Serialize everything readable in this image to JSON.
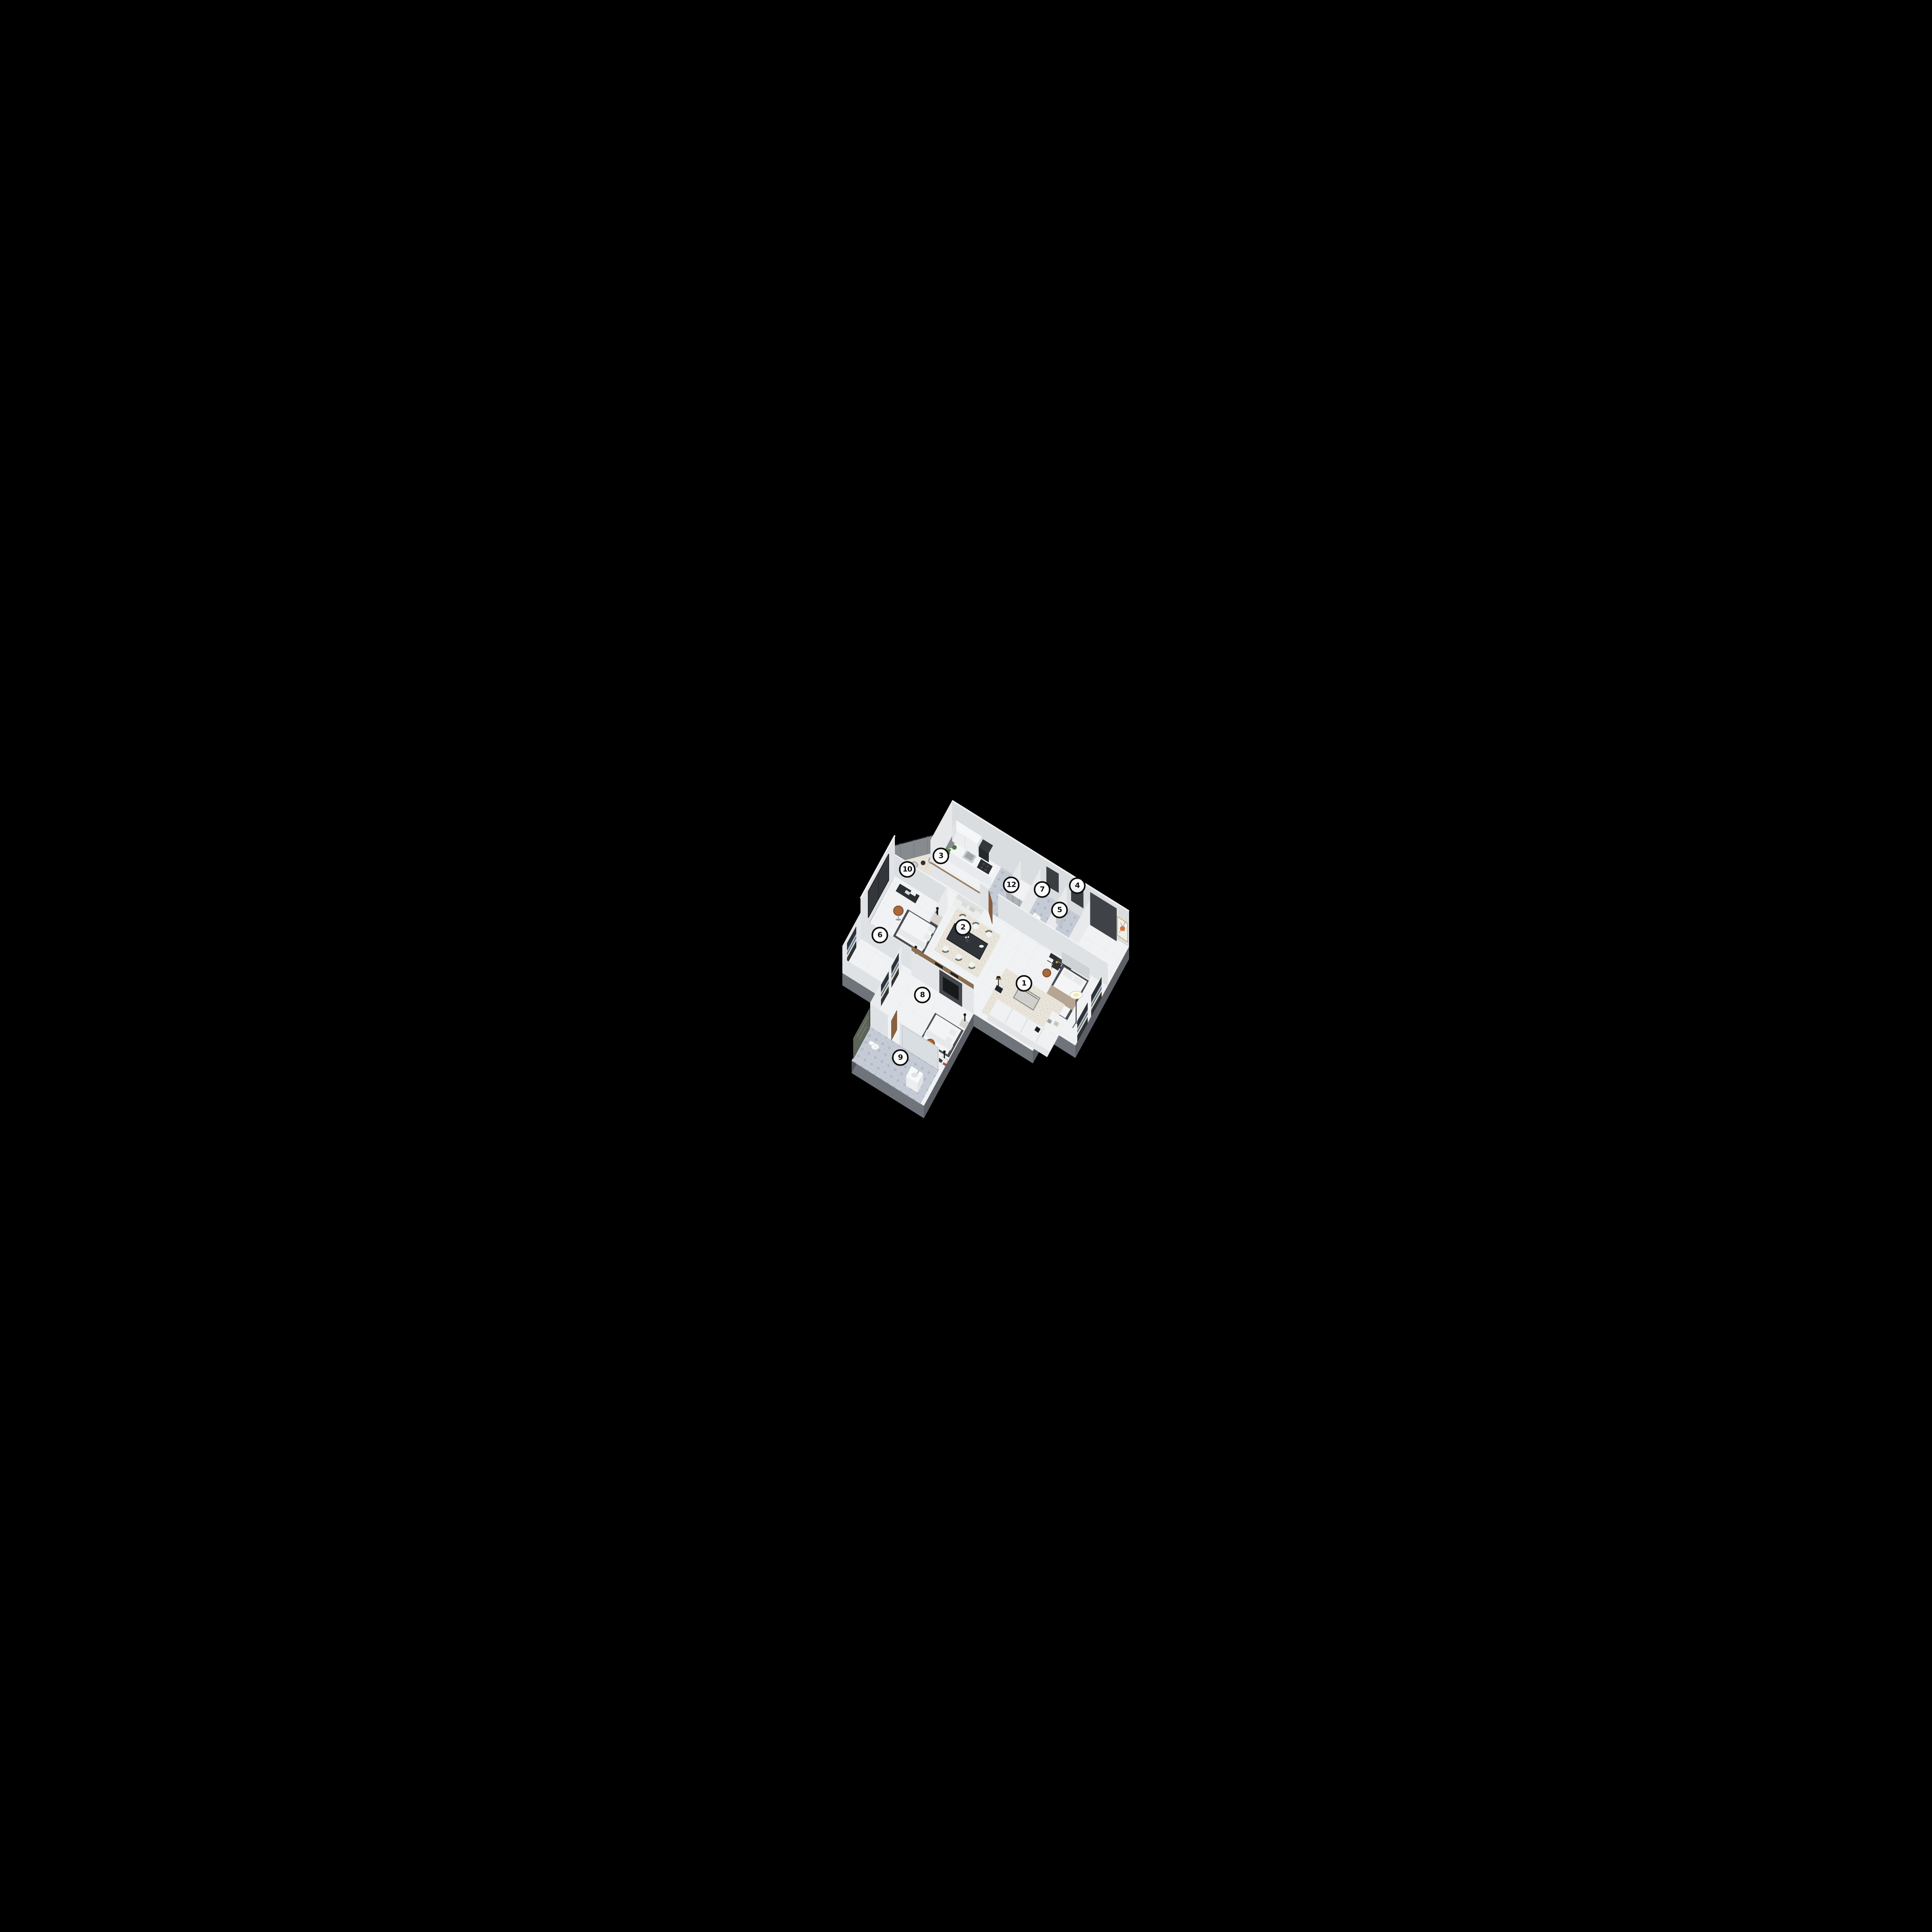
{
  "scene": {
    "type": "isometric-3d-floor-plan",
    "background": "#000000",
    "room_count_labels": 11
  },
  "labels": [
    {
      "value": "1"
    },
    {
      "value": "2"
    },
    {
      "value": "3"
    },
    {
      "value": "4"
    },
    {
      "value": "5"
    },
    {
      "value": "6"
    },
    {
      "value": "7"
    },
    {
      "value": "8"
    },
    {
      "value": "9"
    },
    {
      "value": "10"
    },
    {
      "value": "12"
    }
  ],
  "palette": {
    "background": "#000000",
    "floor_marble": "#f1f2f4",
    "wall": "#dcdfe2",
    "wall_light": "#e8eaec",
    "slab_side": "#5c6066",
    "bath_tile": "#c7cdd7",
    "rug": "#e9e4da",
    "wood": "#8a6f52",
    "door_wood": "#8a5f3c",
    "leather_chair": "#a9693c",
    "olive_chair": "#6e7560",
    "dark_fixture": "#2b2e32",
    "window_dark": "#33373c",
    "art_accent": "#e2702a",
    "clothes_blue": "#a5c2dc",
    "clothes_cream": "#ddd6c6",
    "plant_green": "#4d7a45"
  }
}
